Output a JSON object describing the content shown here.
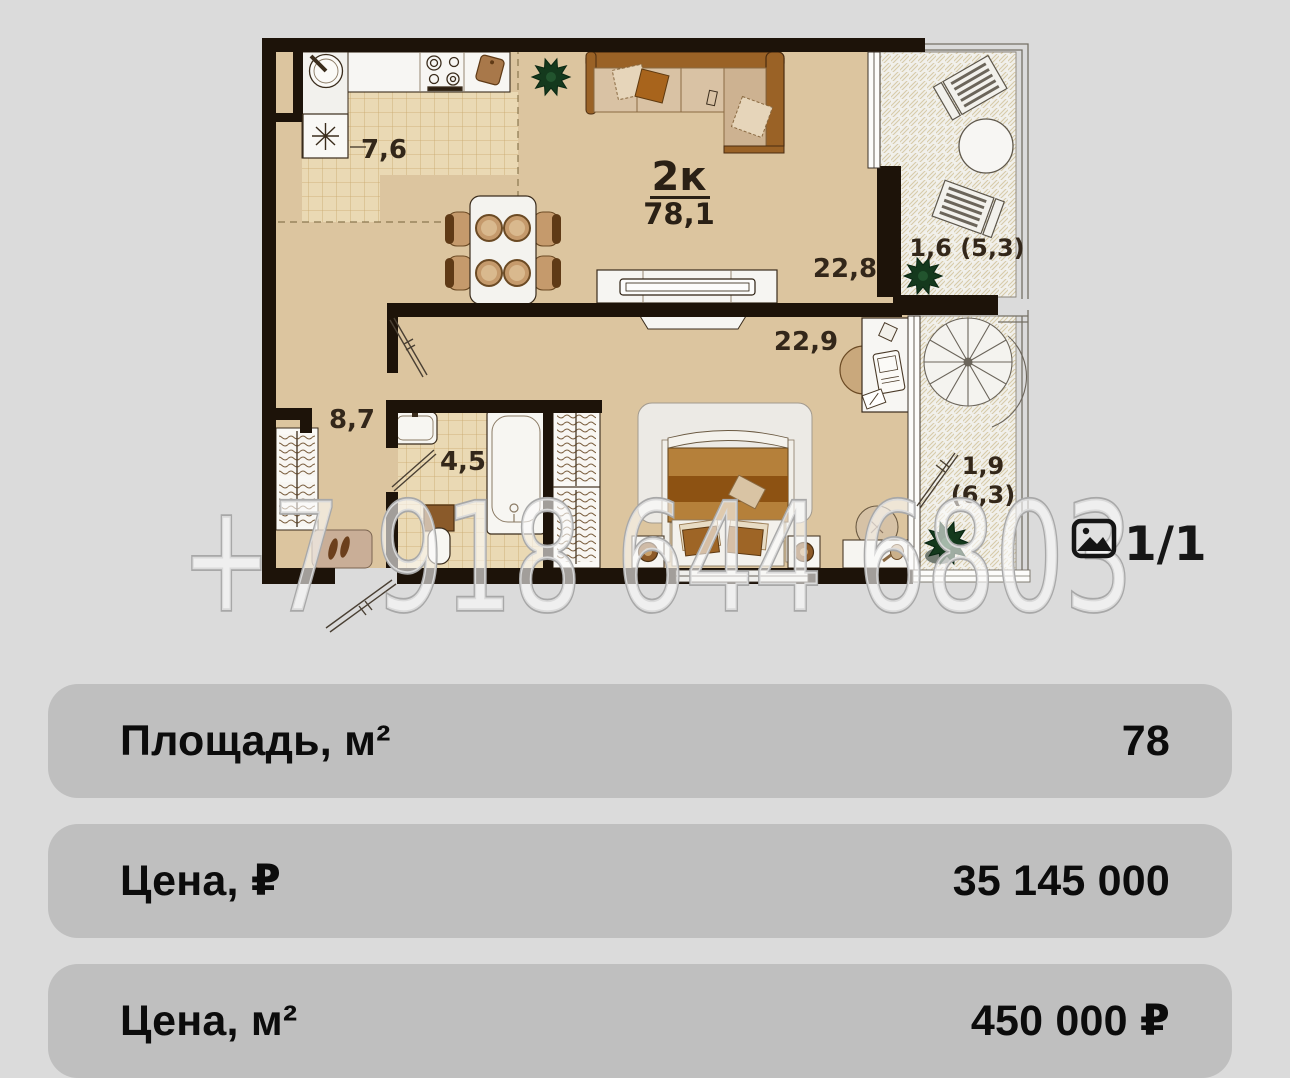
{
  "watermark": "+7 918 644 6803",
  "gallery": {
    "counter": "1/1"
  },
  "floor_plan": {
    "type_label": "2к",
    "total_area": "78,1",
    "areas": {
      "kitchen": "7,6",
      "living": "22,8",
      "bedroom": "22,9",
      "hall": "8,7",
      "bath": "4,5",
      "balcony_top": "1,6 (5,3)",
      "balcony_bottom_line1": "1,9",
      "balcony_bottom_line2": "(6,3)"
    }
  },
  "details": {
    "rows": [
      {
        "label": "Площадь, м²",
        "value": "78"
      },
      {
        "label": "Цена, ₽",
        "value": "35 145 000"
      },
      {
        "label": "Цена, м²",
        "value": "450 000 ₽"
      }
    ]
  },
  "colors": {
    "page_background": "#dbdbdb",
    "card_background": "#bfbfbf",
    "floor": "#dcc59f",
    "walls": "#1d1309",
    "watermark_outline": "#a8a8a8",
    "plant": "#14391d"
  }
}
